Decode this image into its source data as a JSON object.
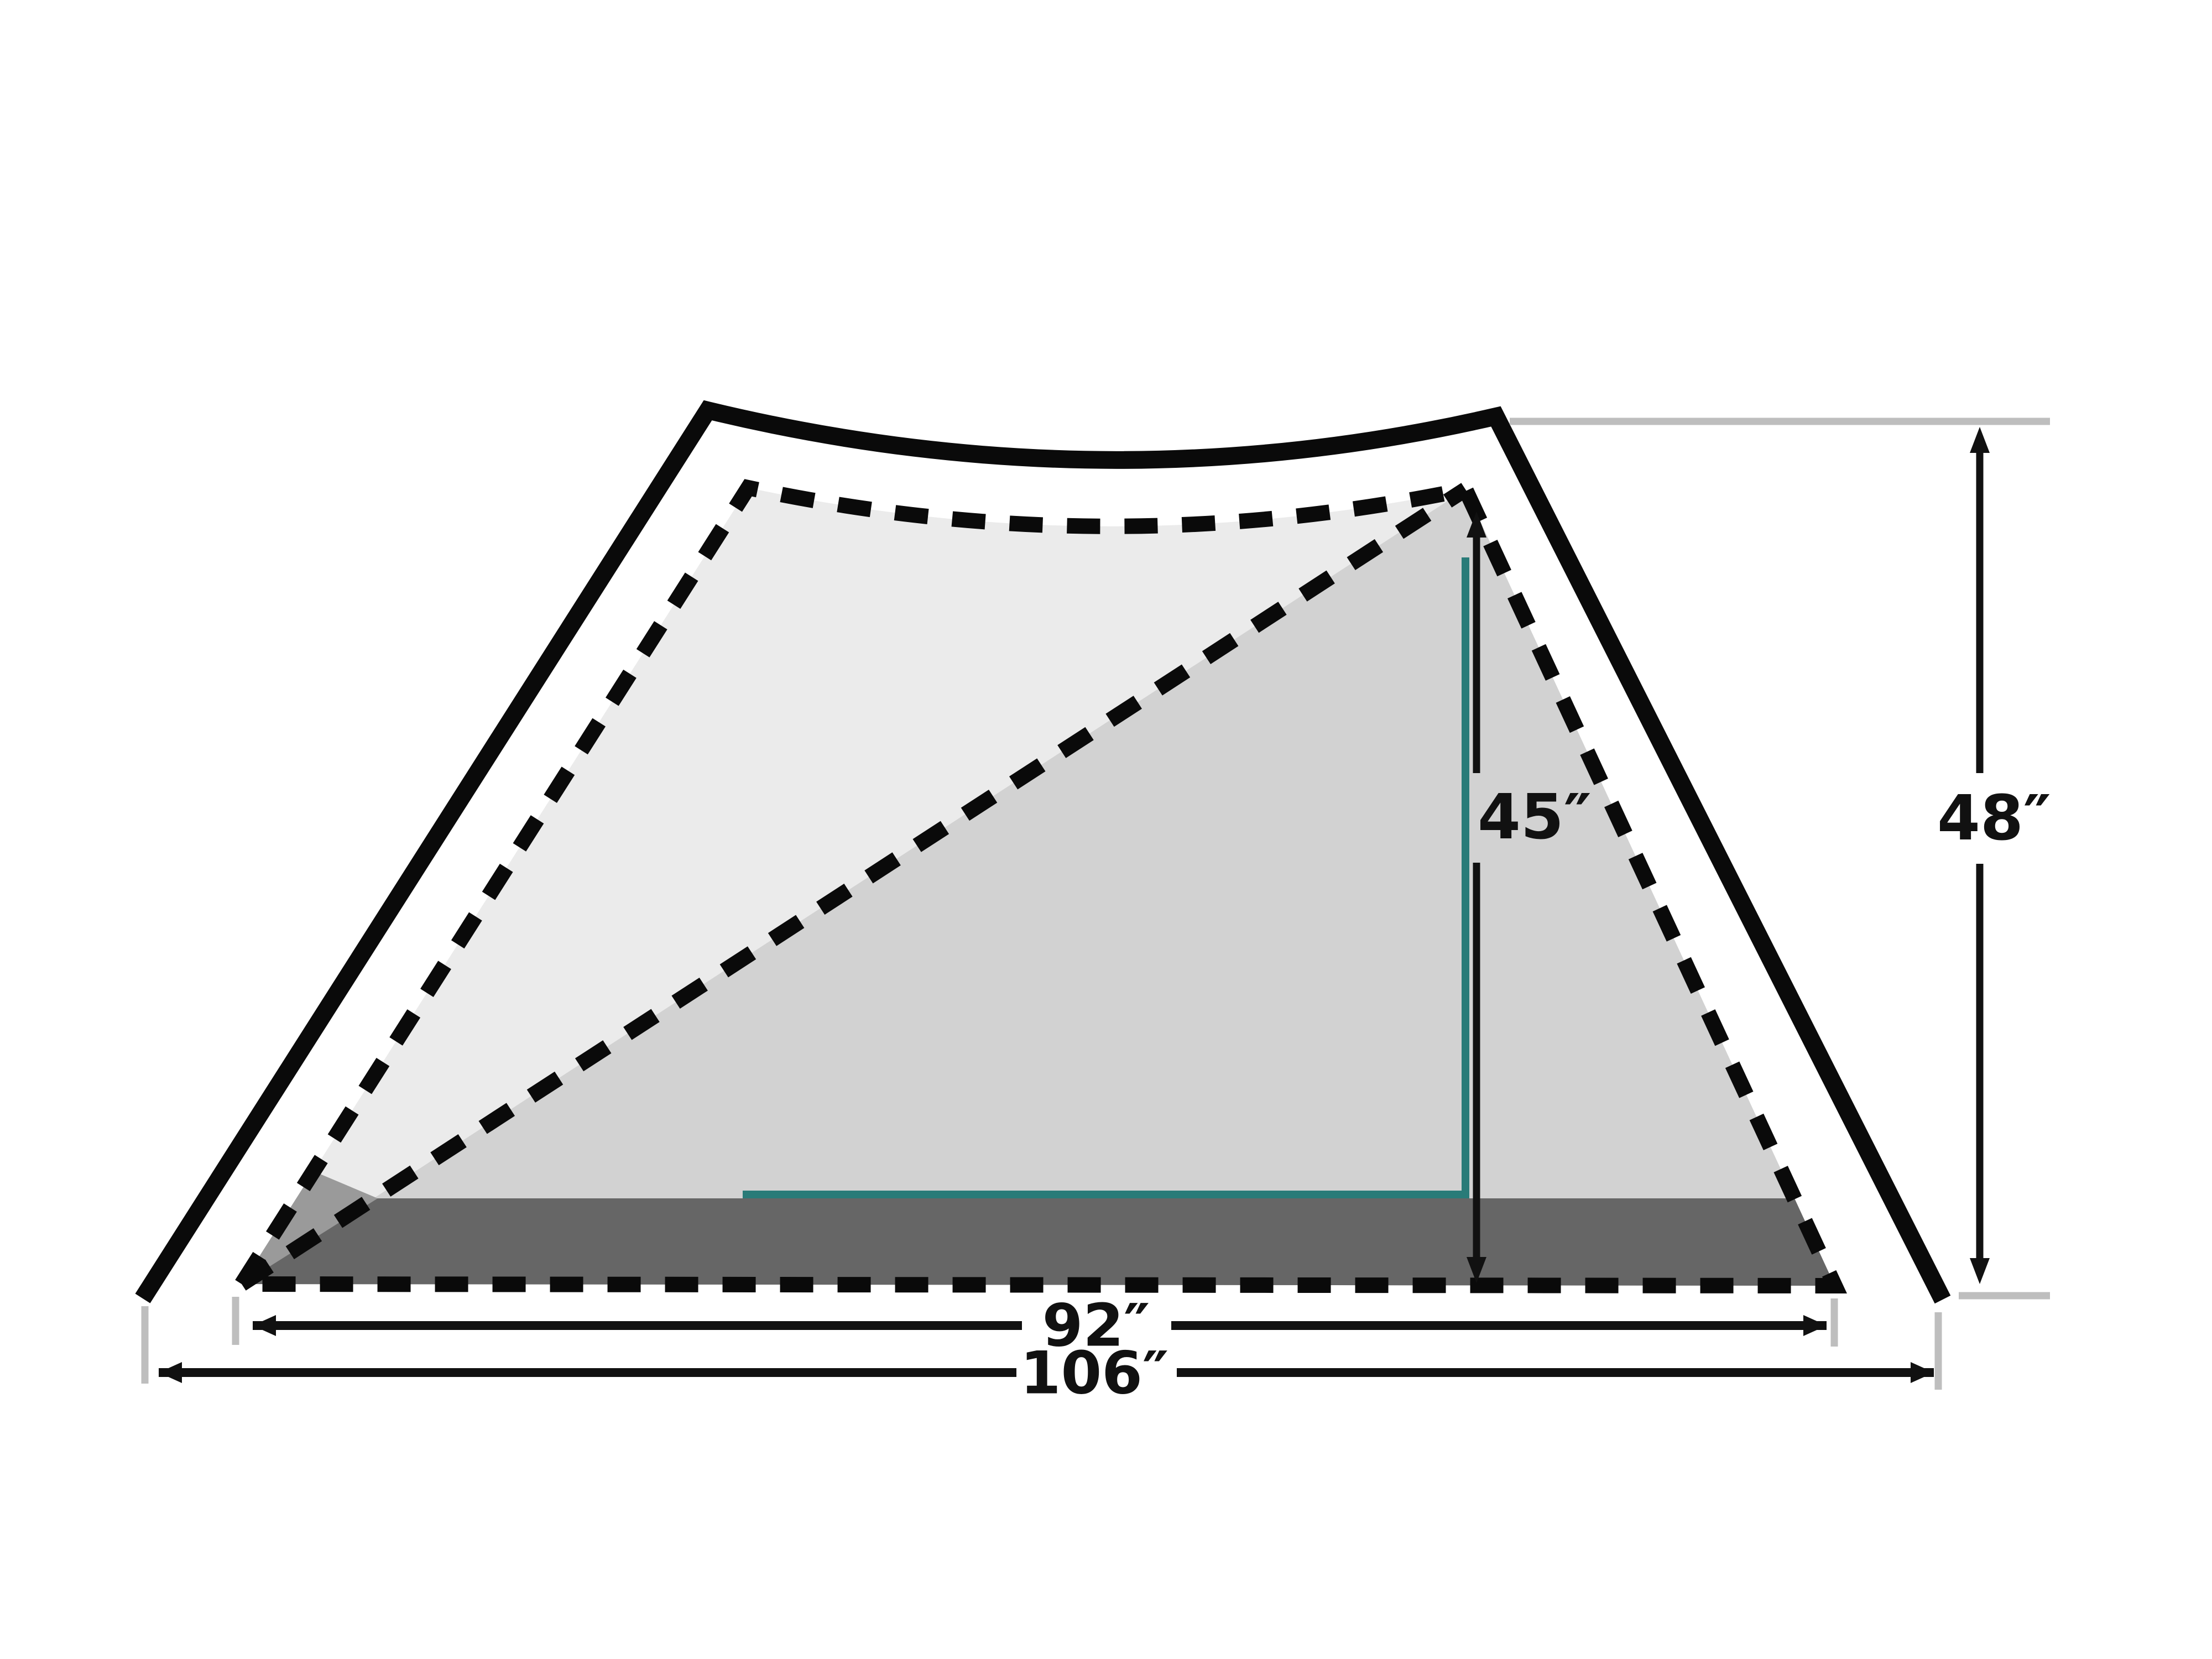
{
  "diagram": {
    "name": "tent-dimensions-diagram",
    "unit": "inches",
    "labels": {
      "interior_height": "45″",
      "peak_height": "48″",
      "inner_width": "92″",
      "outer_width": "106″"
    },
    "measurements": {
      "interior_height_in": 45,
      "peak_height_in": 48,
      "inner_width_in": 92,
      "outer_width_in": 106
    },
    "colors": {
      "background": "#FFFFFF",
      "outline": "#0A0A0A",
      "dimension": "#111111",
      "inner_fill": "#EBEBEB",
      "panel_fill": "#D2D2D2",
      "vestibule_fill": "#9A9A9A",
      "floor_fill": "#666666",
      "height_marker": "#297B78",
      "reference_gray": "#BEBEBE"
    }
  }
}
